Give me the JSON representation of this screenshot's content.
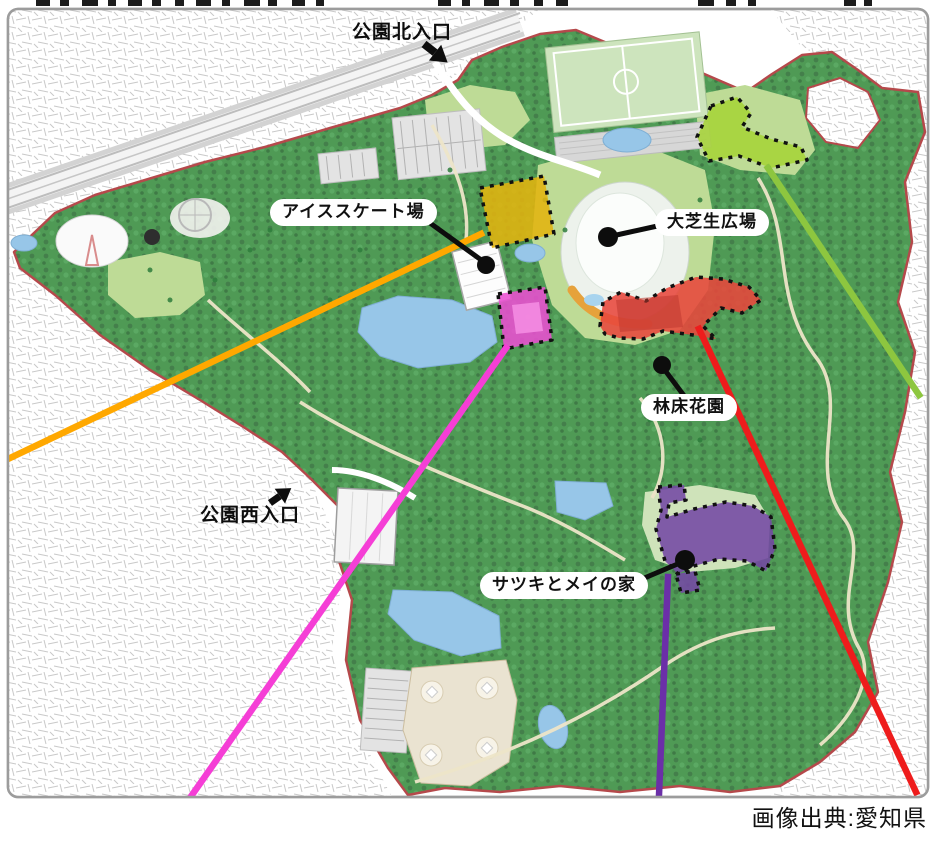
{
  "caption": "画像出典:愛知県",
  "map": {
    "entrances": {
      "north": {
        "label": "公園北入口"
      },
      "west": {
        "label": "公園西入口"
      }
    },
    "points_of_interest": {
      "ice_rink": {
        "label": "アイススケート場"
      },
      "lawn_plaza": {
        "label": "大芝生広場"
      },
      "forest_floor_garden": {
        "label": "林床花園"
      },
      "satsuki_mei_house": {
        "label": "サツキとメイの家"
      }
    },
    "highlight_zones": [
      {
        "id": "zone-yellow",
        "color": "#E3B40F",
        "border": "#111111"
      },
      {
        "id": "zone-magenta",
        "color": "#EA4FD1",
        "border": "#111111"
      },
      {
        "id": "zone-red",
        "color": "#E8473C",
        "border": "#111111"
      },
      {
        "id": "zone-green",
        "color": "#A6D438",
        "border": "#111111"
      },
      {
        "id": "zone-purple",
        "color": "#7448A4",
        "border": "#111111"
      }
    ],
    "callout_lines": [
      {
        "id": "line-orange",
        "color": "#FFA800"
      },
      {
        "id": "line-magenta",
        "color": "#F53ED6"
      },
      {
        "id": "line-purple",
        "color": "#6B2FA8"
      },
      {
        "id": "line-red",
        "color": "#EE1C1C"
      },
      {
        "id": "line-green",
        "color": "#8DC63F"
      }
    ],
    "park_boundary_color": "#B5494B"
  }
}
